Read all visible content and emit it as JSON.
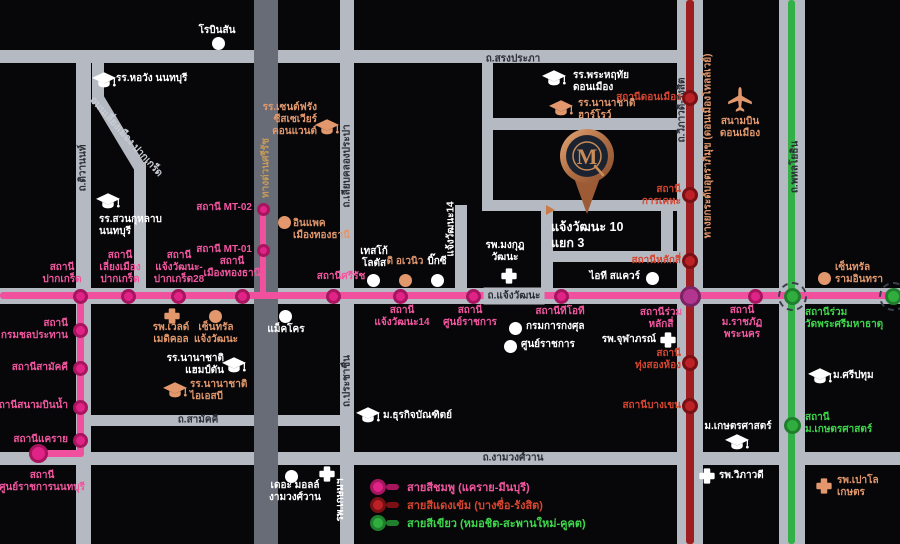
{
  "colors": {
    "bg": "#07070a",
    "road": "#b5b9c2",
    "road_dark": "#676c77",
    "road_label": "#2b2e35",
    "road_light": "#c9cdd4",
    "white": "#ffffff",
    "orange": "#e2986c",
    "tan": "#c59a5c",
    "pink_line": "#f0509e",
    "pink_fill": "#e02487",
    "pink_ring": "#a8155f",
    "red_line": "#9f1c20",
    "red_fill": "#bc2127",
    "red_ring": "#791013",
    "green_line": "#33b148",
    "green_fill": "#2fae3e",
    "green_ring": "#1f7f2c",
    "interchange_fill": "#b23590",
    "interchange_ring": "#7c2364",
    "label_pink": "#f1569f",
    "label_red": "#d6452f",
    "label_green": "#3ed64b",
    "copper": "#c98b58",
    "navy": "#1b2330"
  },
  "roads": [
    {
      "id": "top",
      "x": 0,
      "y": 50,
      "w": 688,
      "h": 13
    },
    {
      "id": "songprapha-link",
      "x": 482,
      "y": 50,
      "w": 11,
      "h": 160
    },
    {
      "id": "songprapha",
      "x": 482,
      "y": 118,
      "w": 208,
      "h": 12
    },
    {
      "id": "chaengwattana",
      "x": 0,
      "y": 288,
      "w": 900,
      "h": 16
    },
    {
      "id": "samakkhi",
      "x": 86,
      "y": 415,
      "w": 266,
      "h": 11
    },
    {
      "id": "ngamwongwan",
      "x": 0,
      "y": 452,
      "w": 900,
      "h": 13
    },
    {
      "id": "tiwanon",
      "x": 76,
      "y": 50,
      "w": 15,
      "h": 494
    },
    {
      "id": "liang-mueang-1",
      "x": 92,
      "y": 58,
      "w": 12,
      "h": 46
    },
    {
      "id": "liang-mueang-diagonal",
      "x": 92,
      "y": 98,
      "w": 12,
      "h": 84,
      "rotate": -31
    },
    {
      "id": "liang-mueang-2",
      "x": 134,
      "y": 162,
      "w": 12,
      "h": 134
    },
    {
      "id": "si-rat-expressway",
      "x": 254,
      "y": 0,
      "w": 24,
      "h": 544,
      "color": "road_dark"
    },
    {
      "id": "liab-khlong-prapa",
      "x": 340,
      "y": 0,
      "w": 14,
      "h": 544
    },
    {
      "id": "soi-chaengwattana-14",
      "x": 455,
      "y": 205,
      "w": 12,
      "h": 91
    },
    {
      "id": "soi-north",
      "x": 482,
      "y": 200,
      "w": 208,
      "h": 11
    },
    {
      "id": "soi-west",
      "x": 541,
      "y": 200,
      "w": 12,
      "h": 96
    },
    {
      "id": "soi-east",
      "x": 661,
      "y": 200,
      "w": 12,
      "h": 62
    },
    {
      "id": "soi-south",
      "x": 541,
      "y": 251,
      "w": 149,
      "h": 11
    },
    {
      "id": "vibhavadi-band",
      "x": 677,
      "y": 0,
      "w": 26,
      "h": 544
    },
    {
      "id": "phahonyothin-band",
      "x": 779,
      "y": 0,
      "w": 26,
      "h": 544
    }
  ],
  "road_labels": [
    {
      "text": "ถ.สรงประภา",
      "x": 513,
      "y": 59,
      "color": "road_label"
    },
    {
      "text": "ถ.แจ้งวัฒนะ",
      "x": 514,
      "y": 296,
      "color": "road_label",
      "bg": true
    },
    {
      "text": "ถ.สามัคคี",
      "x": 198,
      "y": 420,
      "color": "road_label"
    },
    {
      "text": "ถ.งามวงศ์วาน",
      "x": 513,
      "y": 458,
      "color": "road_label"
    },
    {
      "text": "ถ.ติวานนท์",
      "x": 83,
      "y": 168,
      "color": "road_label",
      "rotate": -90
    },
    {
      "text": "ถนนเลี่ยงเมือง ปากเกร็ด",
      "x": 126,
      "y": 137,
      "color": "road_light",
      "rotate": 48
    },
    {
      "text": "ทางด่วนศรีรัช",
      "x": 266,
      "y": 168,
      "color": "tan",
      "rotate": -90
    },
    {
      "text": "ถ.เลียบคลองประปา",
      "x": 347,
      "y": 166,
      "color": "road_label",
      "rotate": -90
    },
    {
      "text": "ถ.ประชาชื่น",
      "x": 347,
      "y": 381,
      "color": "road_label",
      "rotate": -90
    },
    {
      "text": "แจ้งวัฒนะ14",
      "x": 451,
      "y": 229,
      "color": "white",
      "rotate": -90
    },
    {
      "text": "ถ.วิภาวดี-รังสิต",
      "x": 682,
      "y": 110,
      "color": "road_label",
      "rotate": -90
    },
    {
      "text": "ทางยกระดับอุตราภิมุข (ดอนเมืองโทลล์เวย์)",
      "x": 708,
      "y": 146,
      "color": "orange",
      "rotate": -90
    },
    {
      "text": "ถ.พหลโยธิน",
      "x": 795,
      "y": 167,
      "color": "road_label",
      "rotate": -90
    }
  ],
  "transit_lines": [
    {
      "id": "pink",
      "color": "pink_line",
      "segments": [
        {
          "x": 0,
          "y": 292,
          "w": 900,
          "h": 7
        },
        {
          "x": 77,
          "y": 292,
          "w": 7,
          "h": 162
        },
        {
          "x": 36,
          "y": 450,
          "w": 48,
          "h": 7
        },
        {
          "x": 260,
          "y": 205,
          "w": 6,
          "h": 91
        }
      ]
    },
    {
      "id": "red",
      "color": "red_line",
      "segments": [
        {
          "x": 686,
          "y": 0,
          "w": 8,
          "h": 544
        }
      ]
    },
    {
      "id": "green",
      "color": "green_line",
      "segments": [
        {
          "x": 788,
          "y": 0,
          "w": 7,
          "h": 544
        }
      ]
    }
  ],
  "stations": [
    {
      "line": "pink",
      "x": 80,
      "y": 296,
      "label": "สถานี\nปากเกร็ด",
      "lx": 62,
      "ly": 274,
      "align": "center"
    },
    {
      "line": "pink",
      "x": 128,
      "y": 296,
      "label": "สถานี\nเลี่ยงเมือง\nปากเกร็ด",
      "lx": 120,
      "ly": 268,
      "align": "center"
    },
    {
      "line": "pink",
      "x": 178,
      "y": 296,
      "label": "สถานี\nแจ้งวัฒนะ-\nปากเกร็ด28",
      "lx": 179,
      "ly": 268,
      "align": "center"
    },
    {
      "line": "pink",
      "x": 242,
      "y": 296,
      "label": "สถานี\nเมืองทองธานี",
      "lx": 232,
      "ly": 268,
      "align": "center"
    },
    {
      "line": "pink",
      "x": 333,
      "y": 296,
      "label": "สถานีศรีรัช",
      "lx": 341,
      "ly": 277,
      "align": "center"
    },
    {
      "line": "pink",
      "x": 400,
      "y": 296,
      "label": "สถานี\nแจ้งวัฒนะ14",
      "lx": 402,
      "ly": 317,
      "align": "center"
    },
    {
      "line": "pink",
      "x": 473,
      "y": 296,
      "label": "สถานี\nศูนย์ราชการ",
      "lx": 470,
      "ly": 317,
      "align": "center"
    },
    {
      "line": "pink",
      "x": 561,
      "y": 296,
      "label": "สถานีทีโอที",
      "lx": 560,
      "ly": 312,
      "align": "center"
    },
    {
      "line": "pink",
      "x": 690,
      "y": 296,
      "type": "interchange",
      "label": "สถานีร่วม\nหลักสี่",
      "lx": 661,
      "ly": 319,
      "align": "center"
    },
    {
      "line": "pink",
      "x": 755,
      "y": 296,
      "label": "สถานี\nม.ราชภัฏ\nพระนคร",
      "lx": 742,
      "ly": 323,
      "align": "center"
    },
    {
      "line": "pink",
      "x": 792,
      "y": 296,
      "type": "green-interchange",
      "dashed": true,
      "label": "สถานีร่วม\nวัดพระศรีมหาธาตุ",
      "lx": 805,
      "ly": 319,
      "align": "left",
      "label_color": "label_green"
    },
    {
      "line": "pink",
      "x": 893,
      "y": 296,
      "type": "green-interchange",
      "dashed": true
    },
    {
      "line": "pink",
      "x": 80,
      "y": 330,
      "label": "สถานี\nกรมชลประทาน",
      "lx": 68,
      "ly": 330,
      "align": "right"
    },
    {
      "line": "pink",
      "x": 80,
      "y": 368,
      "label": "สถานีสามัคคี",
      "lx": 68,
      "ly": 368,
      "align": "right"
    },
    {
      "line": "pink",
      "x": 80,
      "y": 407,
      "label": "สถานีสนามบินน้ำ",
      "lx": 68,
      "ly": 406,
      "align": "right"
    },
    {
      "line": "pink",
      "x": 80,
      "y": 440,
      "label": "สถานีแคราย",
      "lx": 68,
      "ly": 440,
      "align": "right"
    },
    {
      "line": "pink",
      "x": 38,
      "y": 453,
      "type": "terminal",
      "label": "สถานี\nศูนย์ราชการนนทบุรี",
      "lx": 42,
      "ly": 482,
      "align": "center"
    },
    {
      "line": "pink",
      "x": 263,
      "y": 209,
      "type": "mt",
      "label": "สถานี MT-02",
      "lx": 252,
      "ly": 208,
      "align": "right"
    },
    {
      "line": "pink",
      "x": 263,
      "y": 250,
      "type": "mt",
      "label": "สถานี MT-01",
      "lx": 252,
      "ly": 250,
      "align": "right"
    },
    {
      "line": "red",
      "x": 690,
      "y": 98,
      "label": "สถานีดอนเมือง",
      "lx": 681,
      "ly": 98,
      "align": "right"
    },
    {
      "line": "red",
      "x": 690,
      "y": 195,
      "label": "สถานี\nการเคหะ",
      "lx": 681,
      "ly": 196,
      "align": "right"
    },
    {
      "line": "red",
      "x": 690,
      "y": 261,
      "label": "สถานีหลักสี่",
      "lx": 681,
      "ly": 261,
      "align": "right"
    },
    {
      "line": "red",
      "x": 690,
      "y": 363,
      "label": "สถานี\nทุ่งสองห้อง",
      "lx": 681,
      "ly": 360,
      "align": "right"
    },
    {
      "line": "red",
      "x": 690,
      "y": 406,
      "label": "สถานีบางเขน",
      "lx": 681,
      "ly": 406,
      "align": "right"
    },
    {
      "line": "green",
      "x": 792,
      "y": 425,
      "label": "สถานี\nม.เกษตรศาสตร์",
      "lx": 805,
      "ly": 424,
      "align": "left"
    }
  ],
  "landmarks": [
    {
      "icon": "dot",
      "color": "white",
      "ix": 218,
      "iy": 43,
      "label": "โรบินสัน",
      "lx": 217,
      "ly": 31,
      "align": "center"
    },
    {
      "icon": "school",
      "color": "white",
      "ix": 104,
      "iy": 80,
      "label": "รร.หอวัง นนทบุรี",
      "lx": 116,
      "ly": 79,
      "align": "left"
    },
    {
      "icon": "school",
      "color": "orange",
      "ix": 327,
      "iy": 127,
      "label": "รร.เซนต์ฟรัง\nซีสเซเวียร์\nคอนแวนต์",
      "lx": 317,
      "ly": 120,
      "align": "right"
    },
    {
      "icon": "school",
      "color": "white",
      "ix": 554,
      "iy": 78,
      "label": "รร.พระหฤทัย\nดอนเมือง",
      "lx": 573,
      "ly": 82,
      "align": "left"
    },
    {
      "icon": "school",
      "color": "orange",
      "ix": 561,
      "iy": 108,
      "label": "รร.นานาชาติ\nฮาร์โรว์",
      "lx": 578,
      "ly": 110,
      "align": "left"
    },
    {
      "icon": "plane",
      "color": "orange",
      "ix": 740,
      "iy": 100,
      "label": "สนามบิน\nดอนเมือง",
      "lx": 740,
      "ly": 128,
      "align": "center"
    },
    {
      "icon": "dot",
      "color": "orange",
      "ix": 284,
      "iy": 222,
      "label": "อินแพค\nเมืองทองธานี",
      "lx": 293,
      "ly": 230,
      "align": "left"
    },
    {
      "icon": "school",
      "color": "white",
      "ix": 108,
      "iy": 201,
      "label": "รร.สวนกุหลาบ\nนนทบุรี",
      "lx": 99,
      "ly": 226,
      "align": "left"
    },
    {
      "icon": "dot",
      "color": "white",
      "ix": 373,
      "iy": 280,
      "label": "เทสโก้\nโลตัส",
      "lx": 374,
      "ly": 258,
      "align": "center"
    },
    {
      "icon": "dot",
      "color": "orange",
      "ix": 405,
      "iy": 280,
      "label": "ดิ อเวนิว",
      "lx": 405,
      "ly": 262,
      "align": "center"
    },
    {
      "icon": "dot",
      "color": "white",
      "ix": 437,
      "iy": 280,
      "label": "บิ๊กซี",
      "lx": 437,
      "ly": 262,
      "align": "center"
    },
    {
      "icon": "cross",
      "color": "white",
      "ix": 509,
      "iy": 276,
      "label": "รพ.มงกุฎ\nวัฒนะ",
      "lx": 505,
      "ly": 252,
      "align": "center"
    },
    {
      "icon": "dot",
      "color": "white",
      "ix": 652,
      "iy": 278,
      "label": "ไอที สแควร์",
      "lx": 640,
      "ly": 277,
      "align": "right"
    },
    {
      "icon": "dot",
      "color": "white",
      "ix": 515,
      "iy": 328,
      "label": "กรมการกงศุล",
      "lx": 526,
      "ly": 327,
      "align": "left"
    },
    {
      "icon": "dot",
      "color": "white",
      "ix": 510,
      "iy": 346,
      "label": "ศูนย์ราชการ",
      "lx": 521,
      "ly": 345,
      "align": "left"
    },
    {
      "icon": "cross",
      "color": "white",
      "ix": 668,
      "iy": 340,
      "label": "รพ.จุฬาภรณ์",
      "lx": 656,
      "ly": 340,
      "align": "right"
    },
    {
      "icon": "cross",
      "color": "orange",
      "ix": 172,
      "iy": 316,
      "label": "รพ.เว็ลด์\nเมดิคอล",
      "lx": 171,
      "ly": 334,
      "align": "center"
    },
    {
      "icon": "dot",
      "color": "orange",
      "ix": 215,
      "iy": 316,
      "label": "เซ็นทรัล\nแจ้งวัฒนะ",
      "lx": 216,
      "ly": 334,
      "align": "center"
    },
    {
      "icon": "dot",
      "color": "white",
      "ix": 285,
      "iy": 316,
      "label": "แม็คโคร",
      "lx": 286,
      "ly": 330,
      "align": "center"
    },
    {
      "icon": "school",
      "color": "white",
      "ix": 234,
      "iy": 365,
      "label": "รร.นานาชาติ\nแฮมป์ตัน",
      "lx": 224,
      "ly": 365,
      "align": "right"
    },
    {
      "icon": "school",
      "color": "orange",
      "ix": 175,
      "iy": 390,
      "label": "รร.นานาชาติ\nไอเอสบี",
      "lx": 190,
      "ly": 391,
      "align": "left"
    },
    {
      "icon": "school",
      "color": "white",
      "ix": 368,
      "iy": 415,
      "label": "ม.ธุรกิจบัณฑิตย์",
      "lx": 383,
      "ly": 416,
      "align": "left"
    },
    {
      "icon": "dot",
      "color": "white",
      "ix": 291,
      "iy": 476,
      "label": "เดอะ มอลล์\nงามวงศ์วาน",
      "lx": 295,
      "ly": 492,
      "align": "center"
    },
    {
      "icon": "cross",
      "color": "white",
      "ix": 327,
      "iy": 474,
      "label": "รพ.เกษมฯ",
      "lx": 341,
      "ly": 500,
      "align": "center",
      "rotate": -90
    },
    {
      "icon": "cross",
      "color": "white",
      "ix": 707,
      "iy": 476,
      "label": "รพ.วิภาวดี",
      "lx": 719,
      "ly": 476,
      "align": "left"
    },
    {
      "icon": "school",
      "color": "white",
      "ix": 820,
      "iy": 376,
      "label": "ม.ศรีปทุม",
      "lx": 833,
      "ly": 376,
      "align": "left"
    },
    {
      "icon": "school",
      "color": "white",
      "ix": 737,
      "iy": 442,
      "label": "ม.เกษตรศาสตร์",
      "lx": 738,
      "ly": 427,
      "align": "center"
    },
    {
      "icon": "cross",
      "color": "orange",
      "ix": 824,
      "iy": 486,
      "label": "รพ.เปาโล\nเกษตร",
      "lx": 837,
      "ly": 487,
      "align": "left"
    },
    {
      "icon": "dot",
      "color": "orange",
      "ix": 824,
      "iy": 278,
      "label": "เซ็นทรัล\nรามอินทรา",
      "lx": 835,
      "ly": 274,
      "align": "left"
    }
  ],
  "legend": {
    "items": [
      {
        "color": "pink",
        "label": "สายสีชมพู (แคราย-มีนบุรี)"
      },
      {
        "color": "red",
        "label": "สายสีแดงเข้ม (บางซื่อ-รังสิต)"
      },
      {
        "color": "green",
        "label": "สายสีเขียว (หมอชิต-สะพานใหม่-คูคต)"
      }
    ]
  },
  "project_marker": {
    "monogram": "M",
    "label": "แจ้งวัฒนะ 10\nแยก 3"
  }
}
